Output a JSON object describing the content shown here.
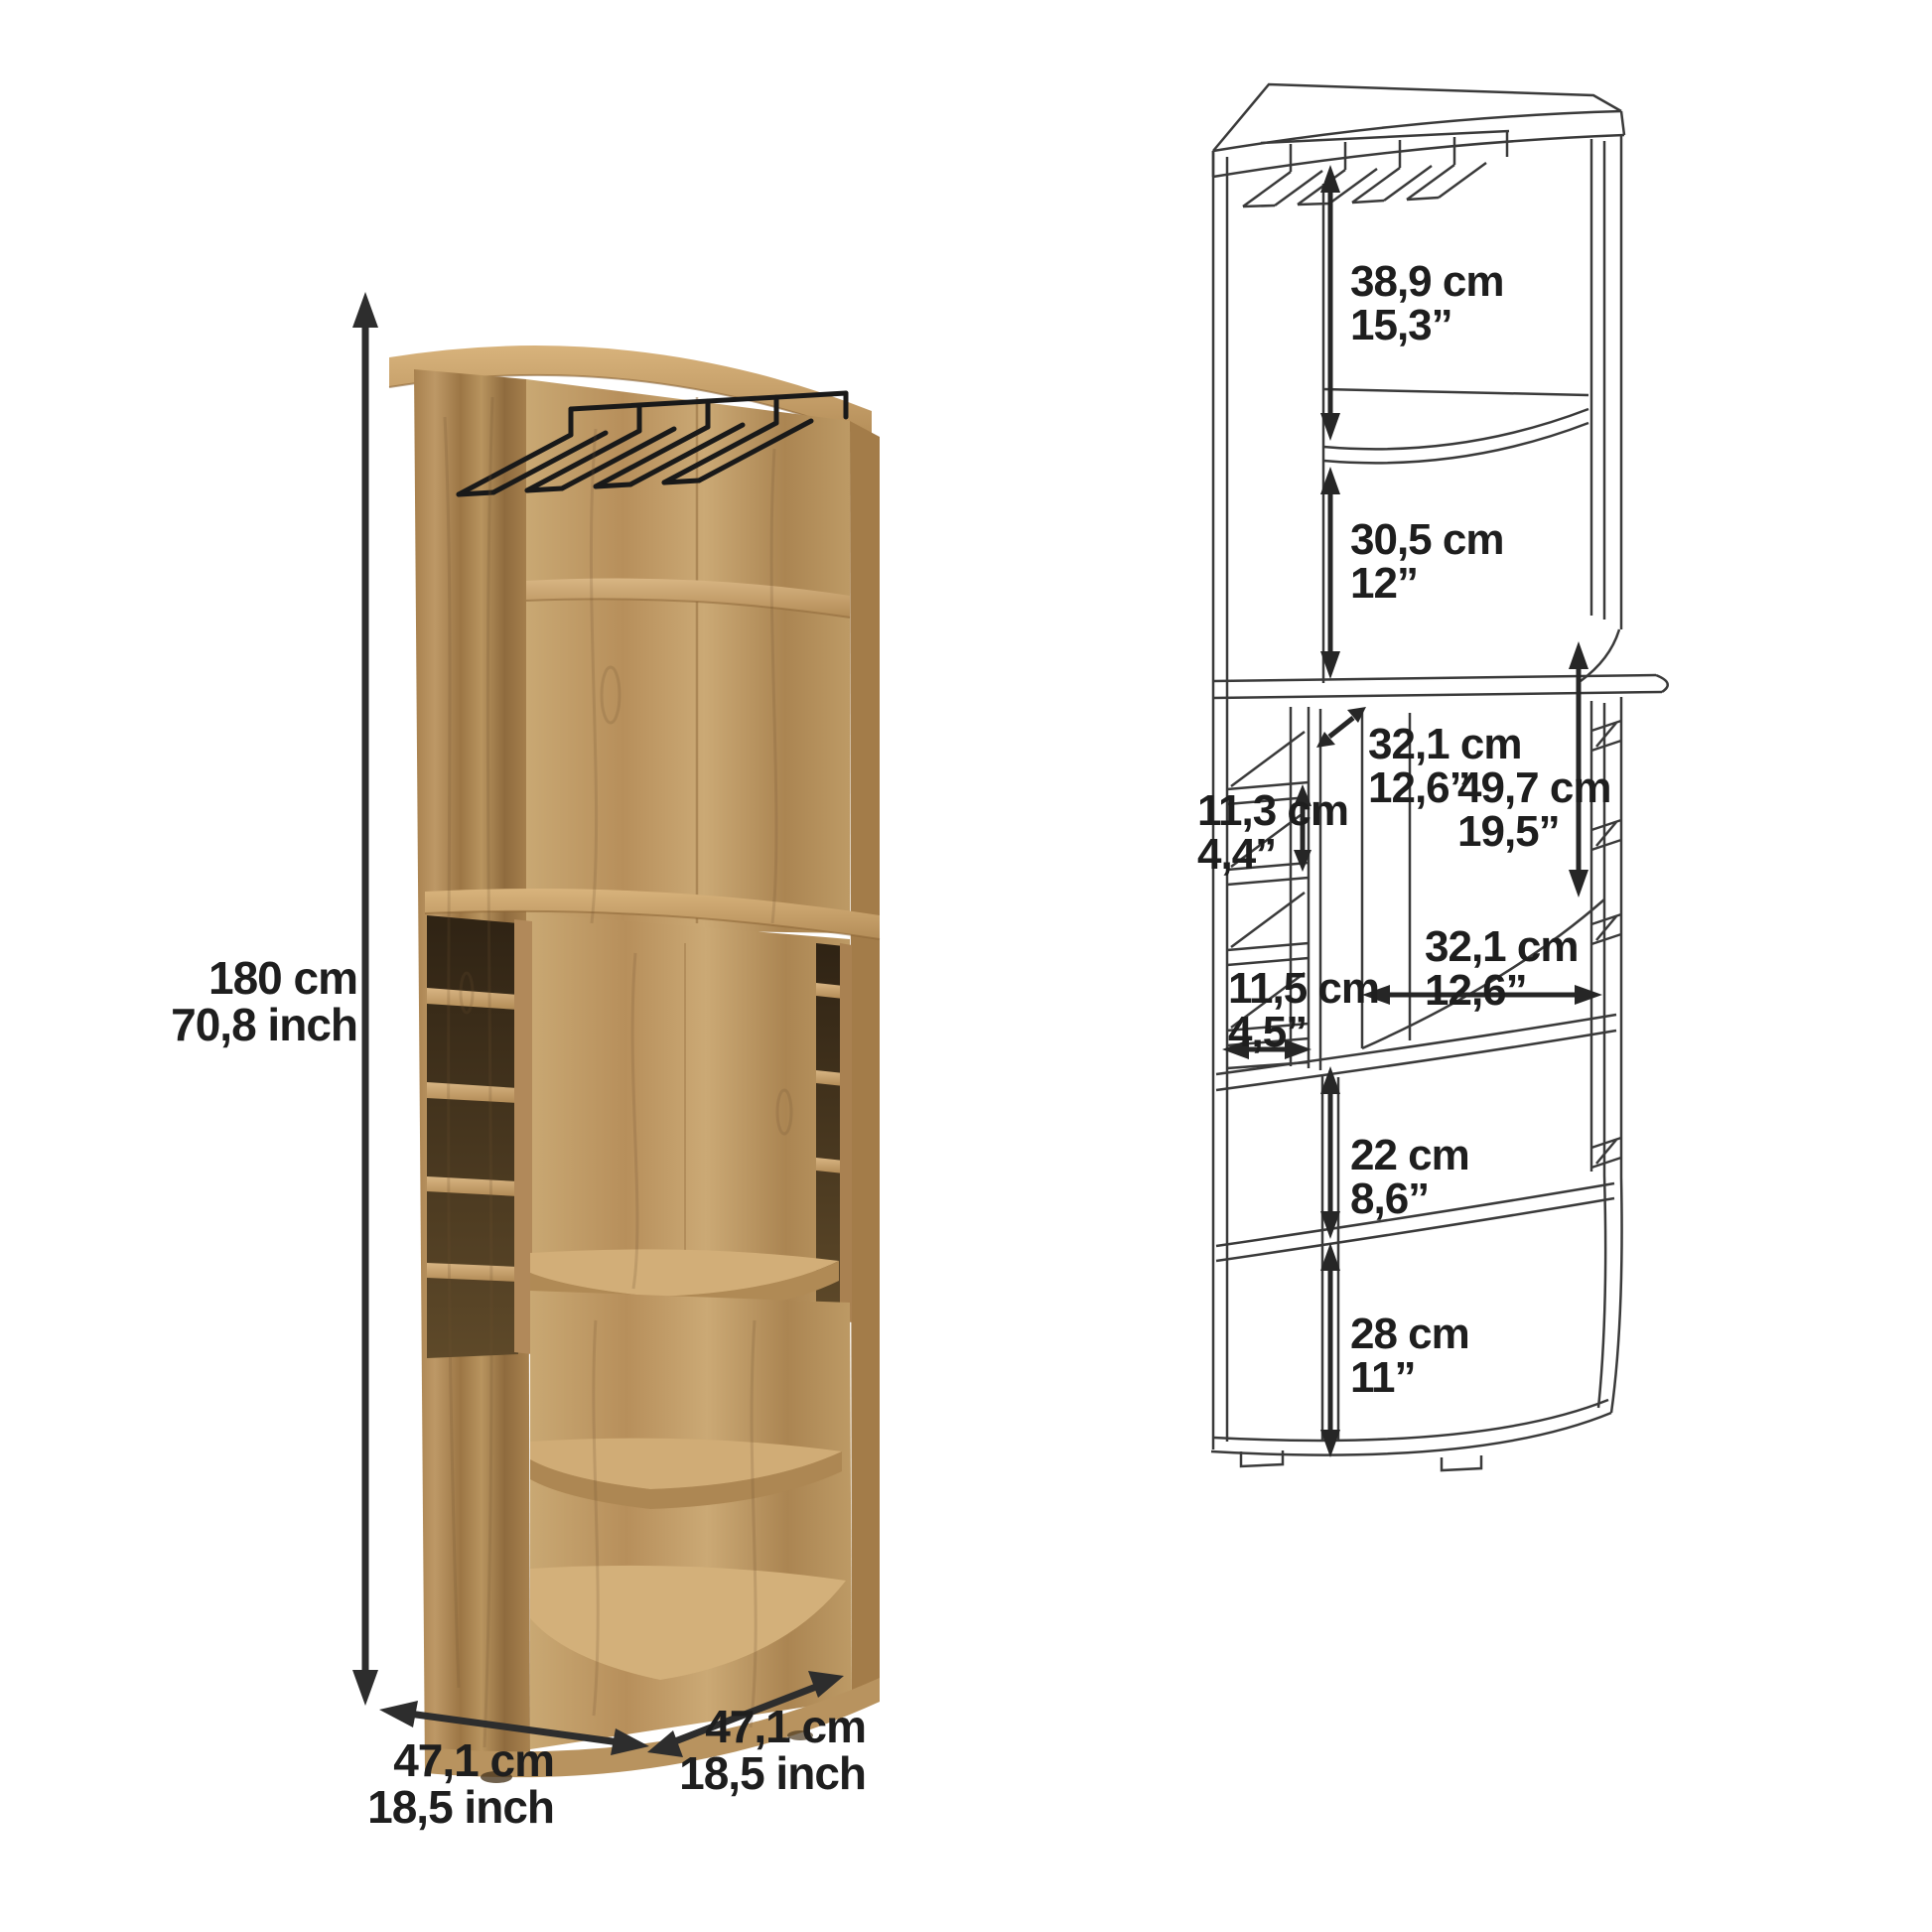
{
  "figure_type": "corner-bar-cabinet-dimension-diagram",
  "colors": {
    "background": "#ffffff",
    "wood_light": "#cfab76",
    "wood_mid": "#b8925e",
    "wood_dark": "#8f6b40",
    "cubby_shadow": "#4a3823",
    "wireframe_line": "#3a3a3a",
    "arrow_and_text": "#1e1e1e"
  },
  "labels": {
    "height": {
      "cm": "180 cm",
      "inch": "70,8 inch"
    },
    "depth_left": {
      "cm": "47,1 cm",
      "inch": "18,5 inch"
    },
    "depth_right": {
      "cm": "47,1 cm",
      "inch": "18,5 inch"
    },
    "rack_section": {
      "cm": "38,9 cm",
      "inch": "15,3”"
    },
    "shelf_section": {
      "cm": "30,5 cm",
      "inch": "12”"
    },
    "middle_depth": {
      "cm": "32,1 cm",
      "inch": "12,6”"
    },
    "cubby_height": {
      "cm": "11,3 cm",
      "inch": "4,4”"
    },
    "middle_height": {
      "cm": "49,7 cm",
      "inch": "19,5”"
    },
    "middle_width": {
      "cm": "32,1 cm",
      "inch": "12,6”"
    },
    "cubby_width": {
      "cm": "11,5 cm",
      "inch": "4,5”"
    },
    "lower_shelf": {
      "cm": "22 cm",
      "inch": "8,6”"
    },
    "bottom_shelf": {
      "cm": "28 cm",
      "inch": "11”"
    }
  }
}
